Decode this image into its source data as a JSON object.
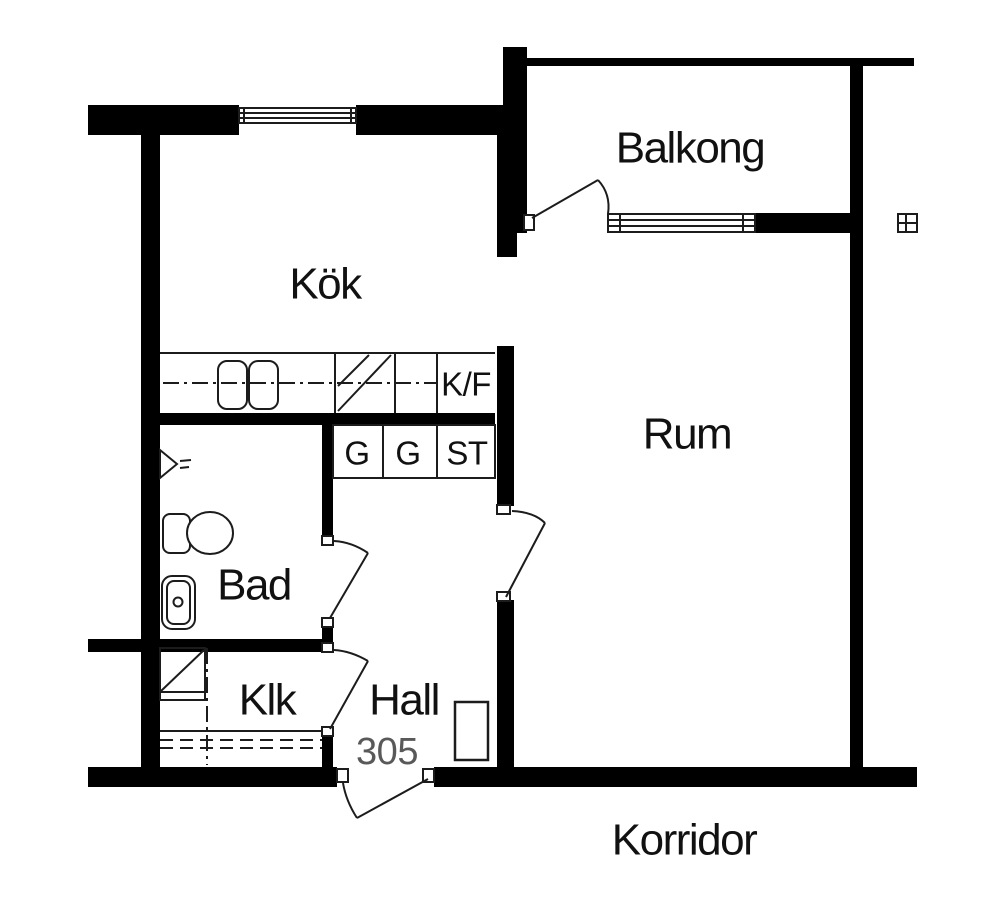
{
  "meta": {
    "type": "apartment-floor-plan",
    "apartment_number": "305"
  },
  "rooms": {
    "balkong": {
      "label": "Balkong"
    },
    "kok": {
      "label": "Kök"
    },
    "rum": {
      "label": "Rum"
    },
    "bad": {
      "label": "Bad"
    },
    "klk": {
      "label": "Klk"
    },
    "hall": {
      "label": "Hall"
    },
    "korridor": {
      "label": "Korridor"
    }
  },
  "fixtures": {
    "fridge_freezer": {
      "label": "K/F"
    },
    "wardrobe_1": {
      "label": "G"
    },
    "wardrobe_2": {
      "label": "G"
    },
    "cleaning_closet": {
      "label": "ST"
    }
  },
  "apartment_number": "305",
  "colors": {
    "wall": "#000000",
    "line": "#1c1c1c",
    "text": "#111111",
    "muted": "#595959",
    "bg": "#ffffff"
  }
}
